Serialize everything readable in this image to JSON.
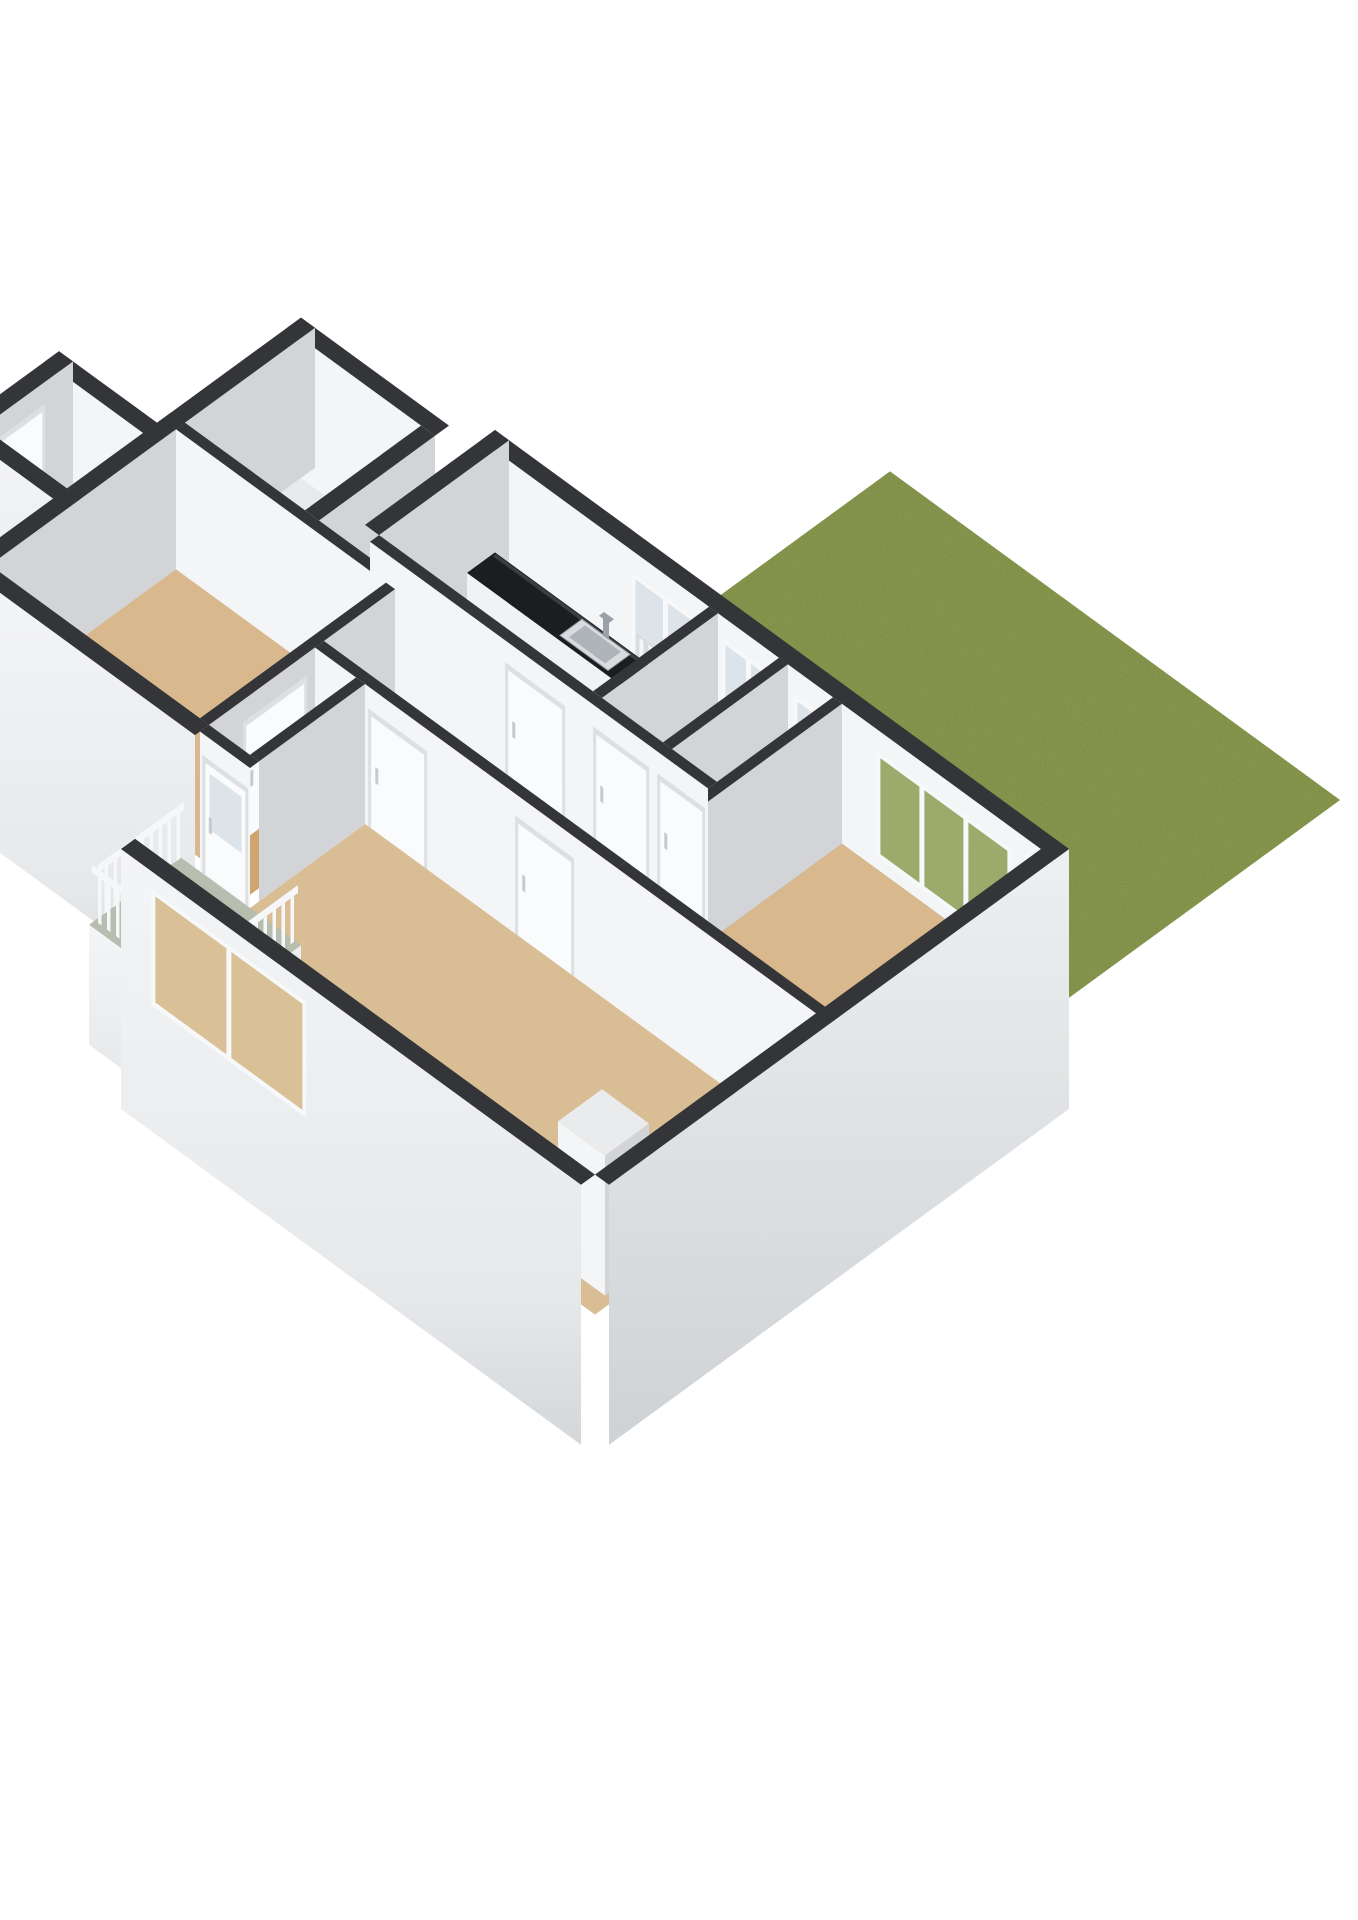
{
  "meta": {
    "type": "isometric-3d-floorplan-render",
    "background": "#ffffff",
    "has_text": false
  },
  "colors": {
    "background": "#ffffff",
    "grass": "#8E9B55",
    "wallTop": "#333538",
    "wallBright": "#F4F5F7",
    "wallGray": "#D2D4D8",
    "wallExterior": "#EFF0F2",
    "wallExteriorDeep": "#CDD0D3",
    "floorHall": "#CEA46F",
    "floorRoom": "#D8B88C",
    "floorLiving": "#D9BD94",
    "floorKitchen": "#EDEFF1",
    "floorService": "#E8EAEC",
    "floorBalcony": "#B7BDAF",
    "showerTray": "#CFDDE7",
    "counter": "#1B1D20",
    "counterSheen": "#3A3D42",
    "cabinet": "#F1F2F4",
    "sinkSteel": "#D8DCDF",
    "sinkBowl": "#AEB4BA",
    "faucet": "#9AA1A8",
    "fixtureWhite": "#F6F8F9",
    "fixtureShade": "#C6CACD",
    "doorWhite": "#FAFBFC",
    "doorFrame": "#DDE0E3",
    "glassPale": "#DCE3E9",
    "glassGarden": "#9DAA6B",
    "glassBeige": "#D9C096",
    "railWhite": "#F6F7F9",
    "redAccent": "#B23B30",
    "chimneyTop": "#E9EBED"
  },
  "scene": {
    "description": "Cut-away 3D floor plan of an apartment viewed isometrically from the south-west, with a square grass garden attached behind the north-east facade.",
    "garden": {
      "name": "garden-lawn",
      "surface": "grass"
    },
    "balcony": {
      "name": "balcony",
      "railing": "white-balusters",
      "floor": "sage"
    },
    "rooms": [
      {
        "id": "kitchen",
        "floor": "floorKitchen",
        "fixtures": [
          "black-countertop",
          "steel-sink",
          "faucet",
          "window-with-radiator",
          "red-appliance",
          "floor-mat"
        ]
      },
      {
        "id": "shower-room",
        "floor": "floorService",
        "fixtures": [
          "shower-tray",
          "window-with-radiator"
        ]
      },
      {
        "id": "toilet-room",
        "floor": "floorService",
        "fixtures": [
          "toilet",
          "small-window"
        ]
      },
      {
        "id": "bedroom-right",
        "floor": "floorRoom",
        "fixtures": [
          "garden-window",
          "door"
        ]
      },
      {
        "id": "hallway",
        "floor": "floorHall",
        "fixtures": [
          "doors-to-all-rooms"
        ]
      },
      {
        "id": "bedroom-left",
        "floor": "floorRoom",
        "fixtures": [
          "door"
        ]
      },
      {
        "id": "living-room",
        "floor": "floorLiving",
        "fixtures": [
          "large-window",
          "chimney-block",
          "two-doors"
        ]
      },
      {
        "id": "entry-porch",
        "floor": "floorHall",
        "fixtures": [
          "front-door"
        ]
      },
      {
        "id": "storage-block",
        "floor": "floorService",
        "fixtures": []
      }
    ]
  }
}
